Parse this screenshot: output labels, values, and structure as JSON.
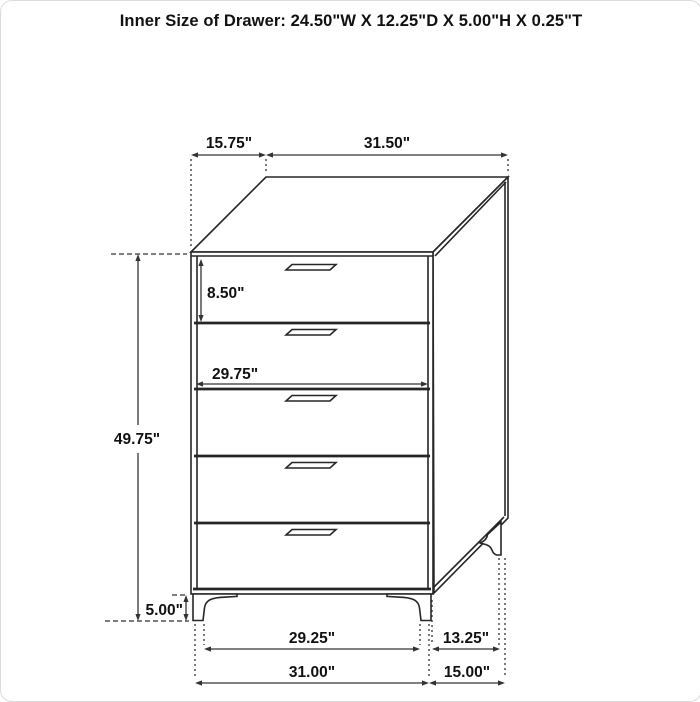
{
  "title": "Inner Size of Drawer: 24.50\"W X 12.25\"D X 5.00\"H X 0.25\"T",
  "chest": {
    "type": "5-drawer chest line drawing",
    "drawer_count": 5
  },
  "dimensions": {
    "top_depth": "15.75\"",
    "top_width": "31.50\"",
    "top_drawer_height": "8.50\"",
    "drawer_opening_width": "29.75\"",
    "body_height": "49.75\"",
    "leg_height": "5.00\"",
    "front_leg_span": "29.25\"",
    "side_leg_span": "13.25\"",
    "overall_width": "31.00\"",
    "overall_depth": "15.00\""
  },
  "colors": {
    "line": "#262626",
    "dimension_line": "#333333",
    "text": "#111111",
    "background": "#ffffff"
  }
}
